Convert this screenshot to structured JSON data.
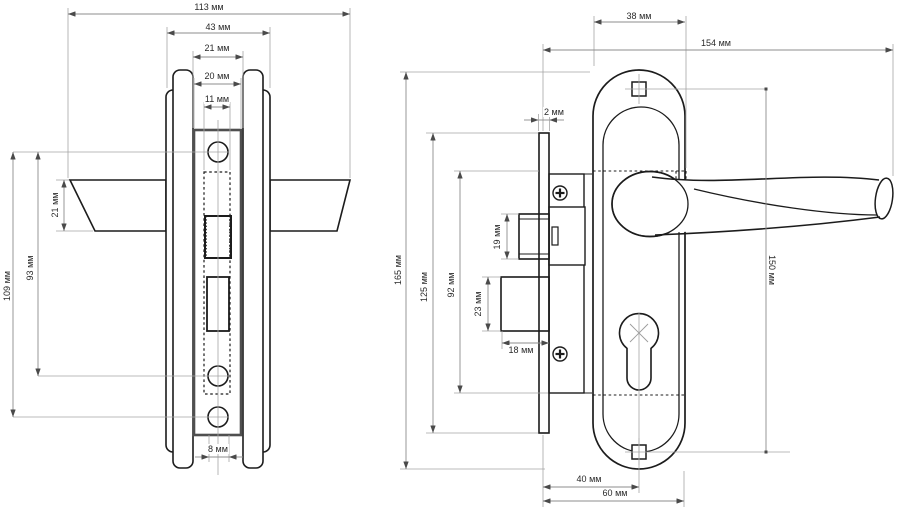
{
  "drawing": {
    "kind": "technical drawing, two orthographic views of a mortise door lock with lever handles",
    "units": "мм",
    "colors": {
      "background": "#ffffff",
      "outline": "#1c1c1c",
      "faceplate_edge": "#4f4f4f",
      "dimension_line": "#8c8c8c",
      "reference_line": "#a5a5a5",
      "text": "#2a2a2a"
    }
  },
  "front_view": {
    "dimensions": {
      "total_width": "113 мм",
      "outer_width": "43 мм",
      "escutcheon_edge_width": "21 мм",
      "faceplate_width": "20 мм",
      "strike_width": "11 мм",
      "handle_section_height": "21 мм",
      "screw_hole_spacing": "93 мм",
      "hole_spacing_total": "109 мм",
      "bottom_hole_width": "8 мм"
    }
  },
  "side_view": {
    "dimensions": {
      "plate_width": "38 мм",
      "total_depth": "154 мм",
      "faceplate_thickness": "2 мм",
      "plate_height": "165 мм",
      "faceplate_height": "125 мм",
      "lock_body_height": "92 мм",
      "latch_height": "19 мм",
      "bolt_height": "23 мм",
      "bolt_depth": "18 мм",
      "screw_spacing": "150 мм",
      "backset": "40 мм",
      "handle_center_offset": "60 мм"
    }
  }
}
